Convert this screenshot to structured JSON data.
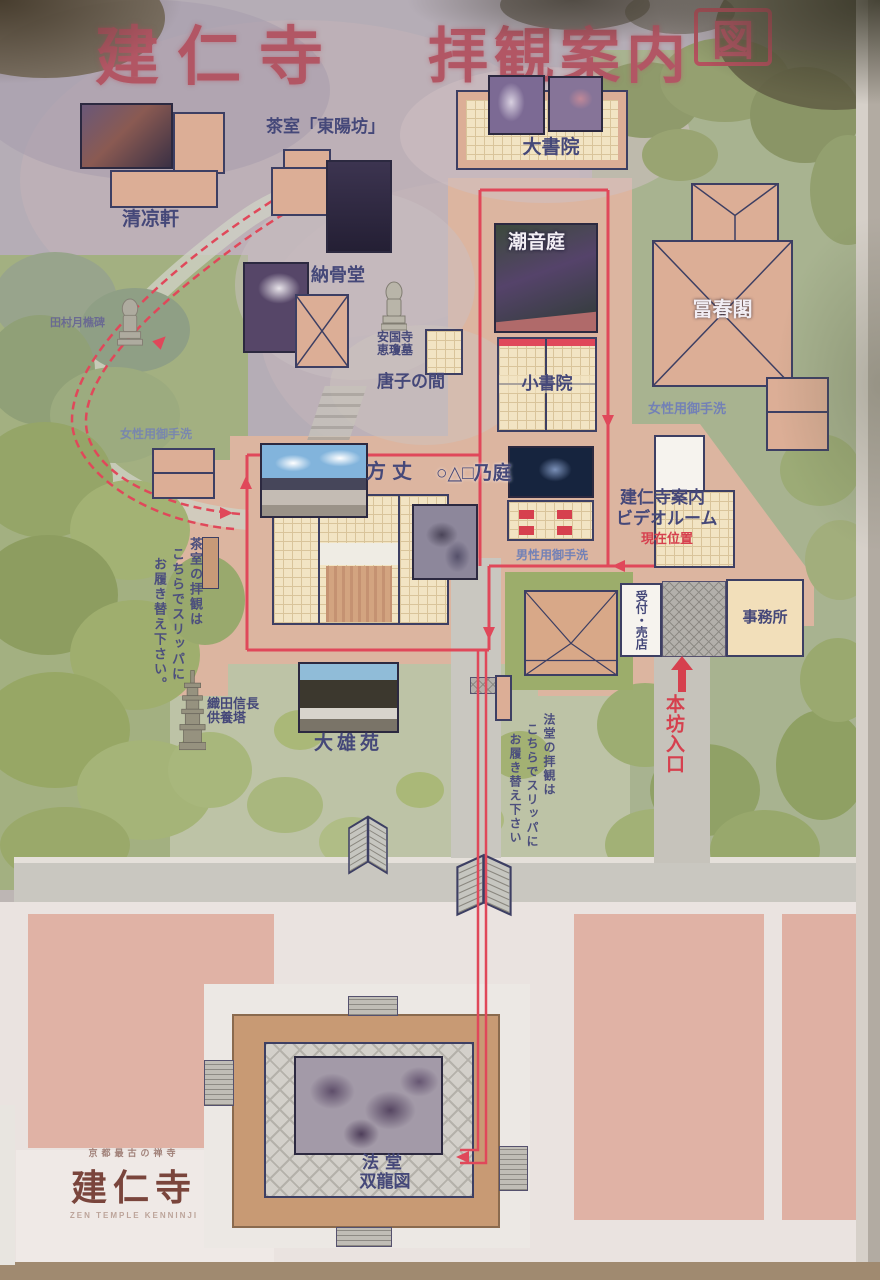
{
  "title": {
    "main": "建仁寺",
    "sub": "拝観案内",
    "boxed": "図"
  },
  "buildings": {
    "seiryoken": "清凉軒",
    "toyobo": "茶室「東陽坊」",
    "nokotsudo": "納骨堂",
    "ankokuji_l1": "安国寺",
    "ankokuji_l2": "恵瓊墓",
    "karako": "唐子の間",
    "daishoin": "大書院",
    "choontei": "潮音庭",
    "shoshoin": "小書院",
    "fushunkaku": "冨春閣",
    "hojo": "方丈",
    "stone_garden": "○△□乃庭",
    "video_l1": "建仁寺案内",
    "video_l2": "ビデオルーム",
    "reception": "受付・売店",
    "office": "事務所",
    "daiouen": "大雄苑",
    "hatto": "法堂",
    "soryuzu": "双龍図"
  },
  "annotations": {
    "genzai": "現在位置",
    "honbo": "本坊入口",
    "ladies_right": "女性用御手洗",
    "ladies_left": "女性用御手洗",
    "mens": "男性用御手洗",
    "tea_note_c1": "茶室の拝観は",
    "tea_note_c2": "こちらでスリッパに",
    "tea_note_c3": "お履き替え下さい。",
    "hatto_note_c1": "法堂の拝観は",
    "hatto_note_c2": "こちらでスリッパに",
    "hatto_note_c3": "お履き替え下さい",
    "nobunaga_l1": "織田信長",
    "nobunaga_l2": "供養塔",
    "tamura": "田村月樵碑"
  },
  "logo": {
    "top": "京都最古の禅寺",
    "main": "建仁寺",
    "eng": "ZEN TEMPLE KENNINJI"
  },
  "colors": {
    "route": "#e0485a",
    "building_pink": "#dcae96",
    "outline_navy": "#3d3f63",
    "title": "#b25664"
  }
}
